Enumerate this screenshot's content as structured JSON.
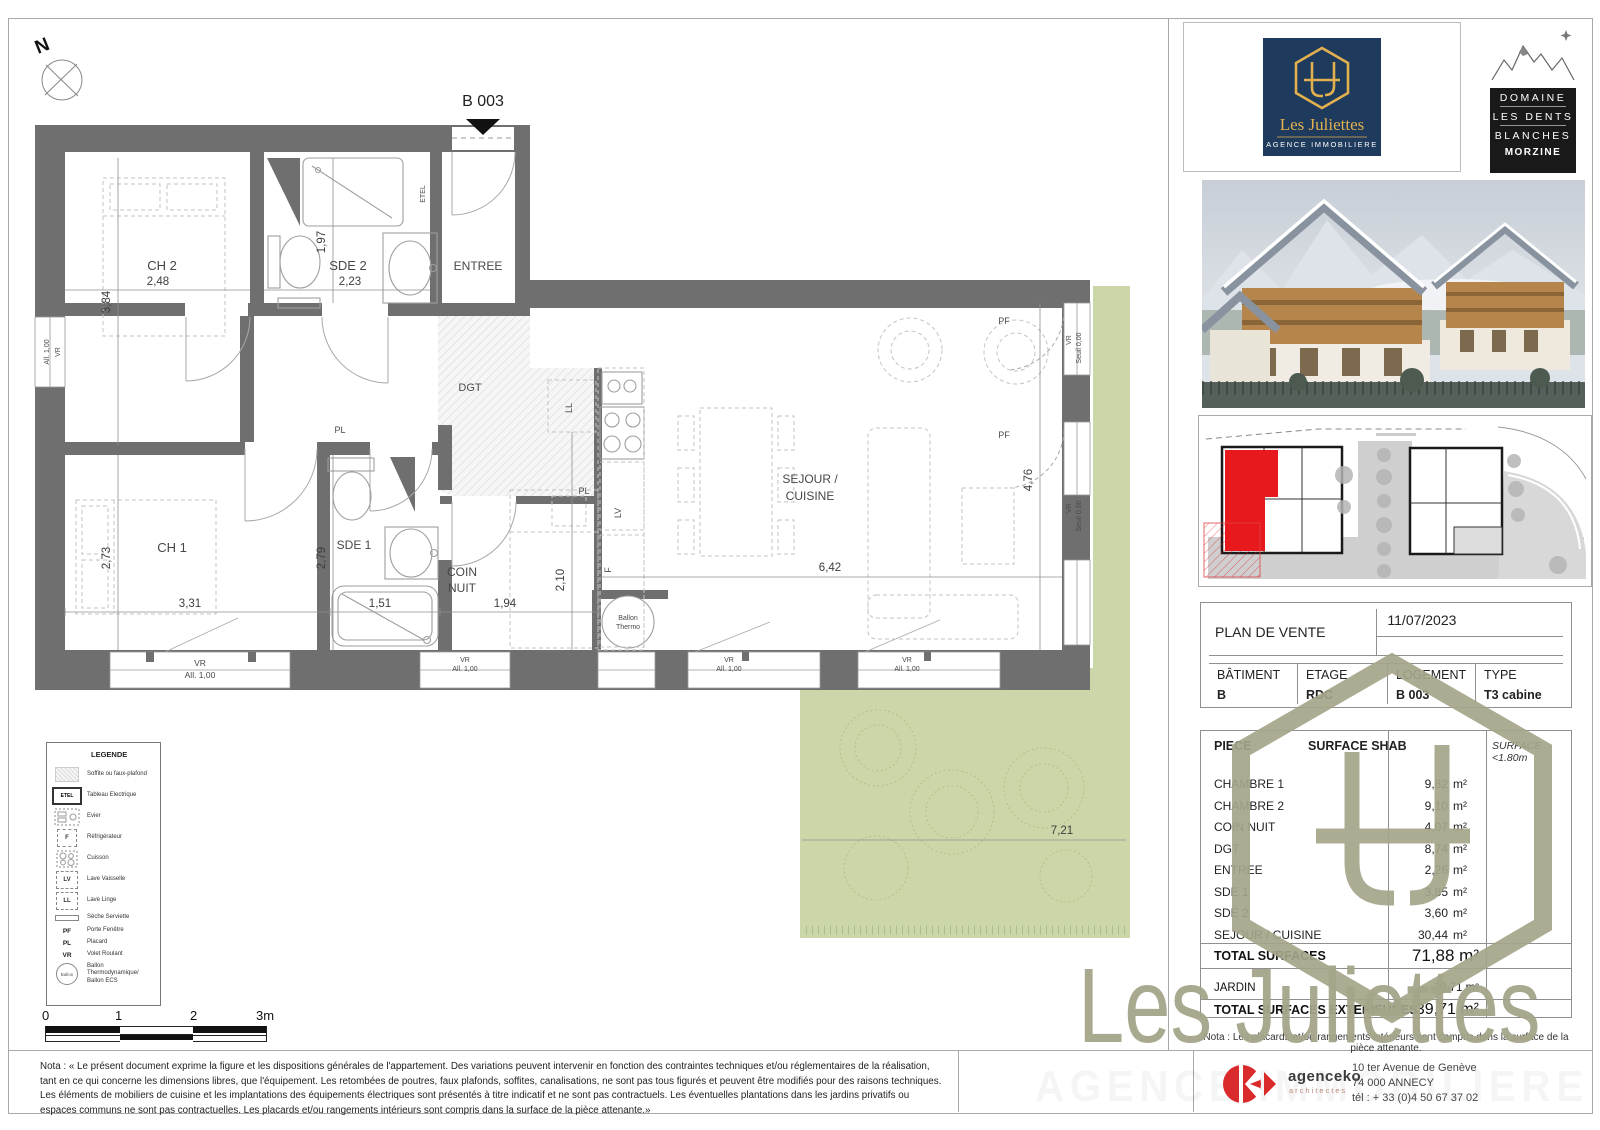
{
  "plan": {
    "unit_label": "B 003",
    "north_label": "N",
    "rooms": {
      "ch2": "CH 2",
      "sde2": "SDE 2",
      "entree": "ENTREE",
      "ch1": "CH 1",
      "sde1": "SDE 1",
      "coin1": "COIN",
      "coin2": "NUIT",
      "dgt": "DGT",
      "sejour1": "SEJOUR /",
      "sejour2": "CUISINE"
    },
    "dims": {
      "ch2_w": "2,48",
      "ch2_h": "3,84",
      "sde2_w": "2,23",
      "sde2_h": "1,97",
      "ch1_w": "3,31",
      "ch1_h": "2,73",
      "sde1_w": "1,51",
      "sde1_h": "2,79",
      "coin_w": "1,94",
      "coin_h": "2,10",
      "sejour_w": "6,42",
      "sejour_h": "4,76",
      "jardin_w": "7,21"
    },
    "tags": {
      "etel": "ETEL",
      "pl": "PL",
      "ll": "LL",
      "lv": "LV",
      "f": "F",
      "vr": "VR",
      "pf": "PF",
      "all100": "All. 1,00",
      "seuil": "Seuil 0,00",
      "ballon1": "Ballon",
      "ballon2": "Thermo"
    }
  },
  "legend": {
    "title": "LEGENDE",
    "items": [
      {
        "key": "",
        "label": "Soffite ou faux-plafond"
      },
      {
        "key": "ETEL",
        "label": "Tableau Electrique"
      },
      {
        "key": "",
        "label": "Evier"
      },
      {
        "key": "F",
        "label": "Réfrigérateur"
      },
      {
        "key": "",
        "label": "Cuisson"
      },
      {
        "key": "LV",
        "label": "Lave Vaisselle"
      },
      {
        "key": "LL",
        "label": "Lave Linge"
      },
      {
        "key": "",
        "label": "Sèche Serviette"
      },
      {
        "key": "PF",
        "label": "Porte Fenêtre"
      },
      {
        "key": "PL",
        "label": "Placard"
      },
      {
        "key": "VR",
        "label": "Volet Roulant"
      },
      {
        "key": "Ballon",
        "label": "Ballon Thermodynamique/ Ballon ECS"
      }
    ]
  },
  "scalebar": {
    "t0": "0",
    "t1": "1",
    "t2": "2",
    "t3": "3m"
  },
  "brand": {
    "name": "Les Juliettes",
    "tagline": "AGENCE IMMOBILIERE"
  },
  "domaine": {
    "l1": "DOMAINE",
    "l2": "LES DENTS",
    "l3": "BLANCHES",
    "city": "MORZINE"
  },
  "title_block": {
    "title": "PLAN DE VENTE",
    "date": "11/07/2023",
    "headers": [
      "BÂTIMENT",
      "ETAGE",
      "LOGEMENT",
      "TYPE"
    ],
    "values": [
      "B",
      "RDC",
      "B 003",
      "T3 cabine"
    ]
  },
  "surfaces": {
    "col_piece": "PIECE",
    "col_shab": "SURFACE SHAB",
    "col_lt": "SURFACE <1.80m",
    "unit": "m²",
    "rows": [
      {
        "piece": "CHAMBRE 1",
        "value": "9,82"
      },
      {
        "piece": "CHAMBRE 2",
        "value": "9,10"
      },
      {
        "piece": "COIN NUIT",
        "value": "4,07"
      },
      {
        "piece": "DGT",
        "value": "8,74"
      },
      {
        "piece": "ENTREE",
        "value": "2,26"
      },
      {
        "piece": "SDE 1",
        "value": "3,85"
      },
      {
        "piece": "SDE 2",
        "value": "3,60"
      },
      {
        "piece": "SEJOUR / CUISINE",
        "value": "30,44"
      }
    ],
    "total_label": "TOTAL SURFACES",
    "total_value": "71,88 m²",
    "jardin_label": "JARDIN",
    "jardin_value": "39,71 m²",
    "ext_label": "TOTAL SURFACES EXTERIEURES",
    "ext_value": "39,71 m²",
    "nota": "Nota : Les placards et/ou rangements intérieurs sont compris dans la surface de la pièce attenante."
  },
  "footer": {
    "nota": "Nota : « Le présent document exprime la figure et les dispositions générales de l'appartement. Des variations peuvent intervenir en fonction des contraintes techniques et/ou réglementaires de la réalisation, tant en ce qui concerne les dimensions libres, que l'équipement. Les retombées de poutres, faux plafonds, soffites, canalisations, ne sont pas tous figurés et peuvent être modifiés pour des raisons techniques. Les éléments de mobiliers de cuisine et les implantations des équipements électriques sont présentés à titre indicatif et ne sont pas contractuels. Les éventuelles plantations dans les jardins privatifs ou espaces communs ne sont pas contractuelles. Les placards et/ou rangements intérieurs sont compris dans la surface de la pièce attenante.»",
    "agency_name": "agenceko",
    "agency_sub": "architectes",
    "addr1": "10 ter Avenue de Genève",
    "addr2": "74 000 ANNECY",
    "addr3": "tél : + 33 (0)4 50 67 37 02",
    "watermark": "AGENCE IMMOBILIERE"
  },
  "watermark": {
    "text": "Les Juliettes"
  }
}
